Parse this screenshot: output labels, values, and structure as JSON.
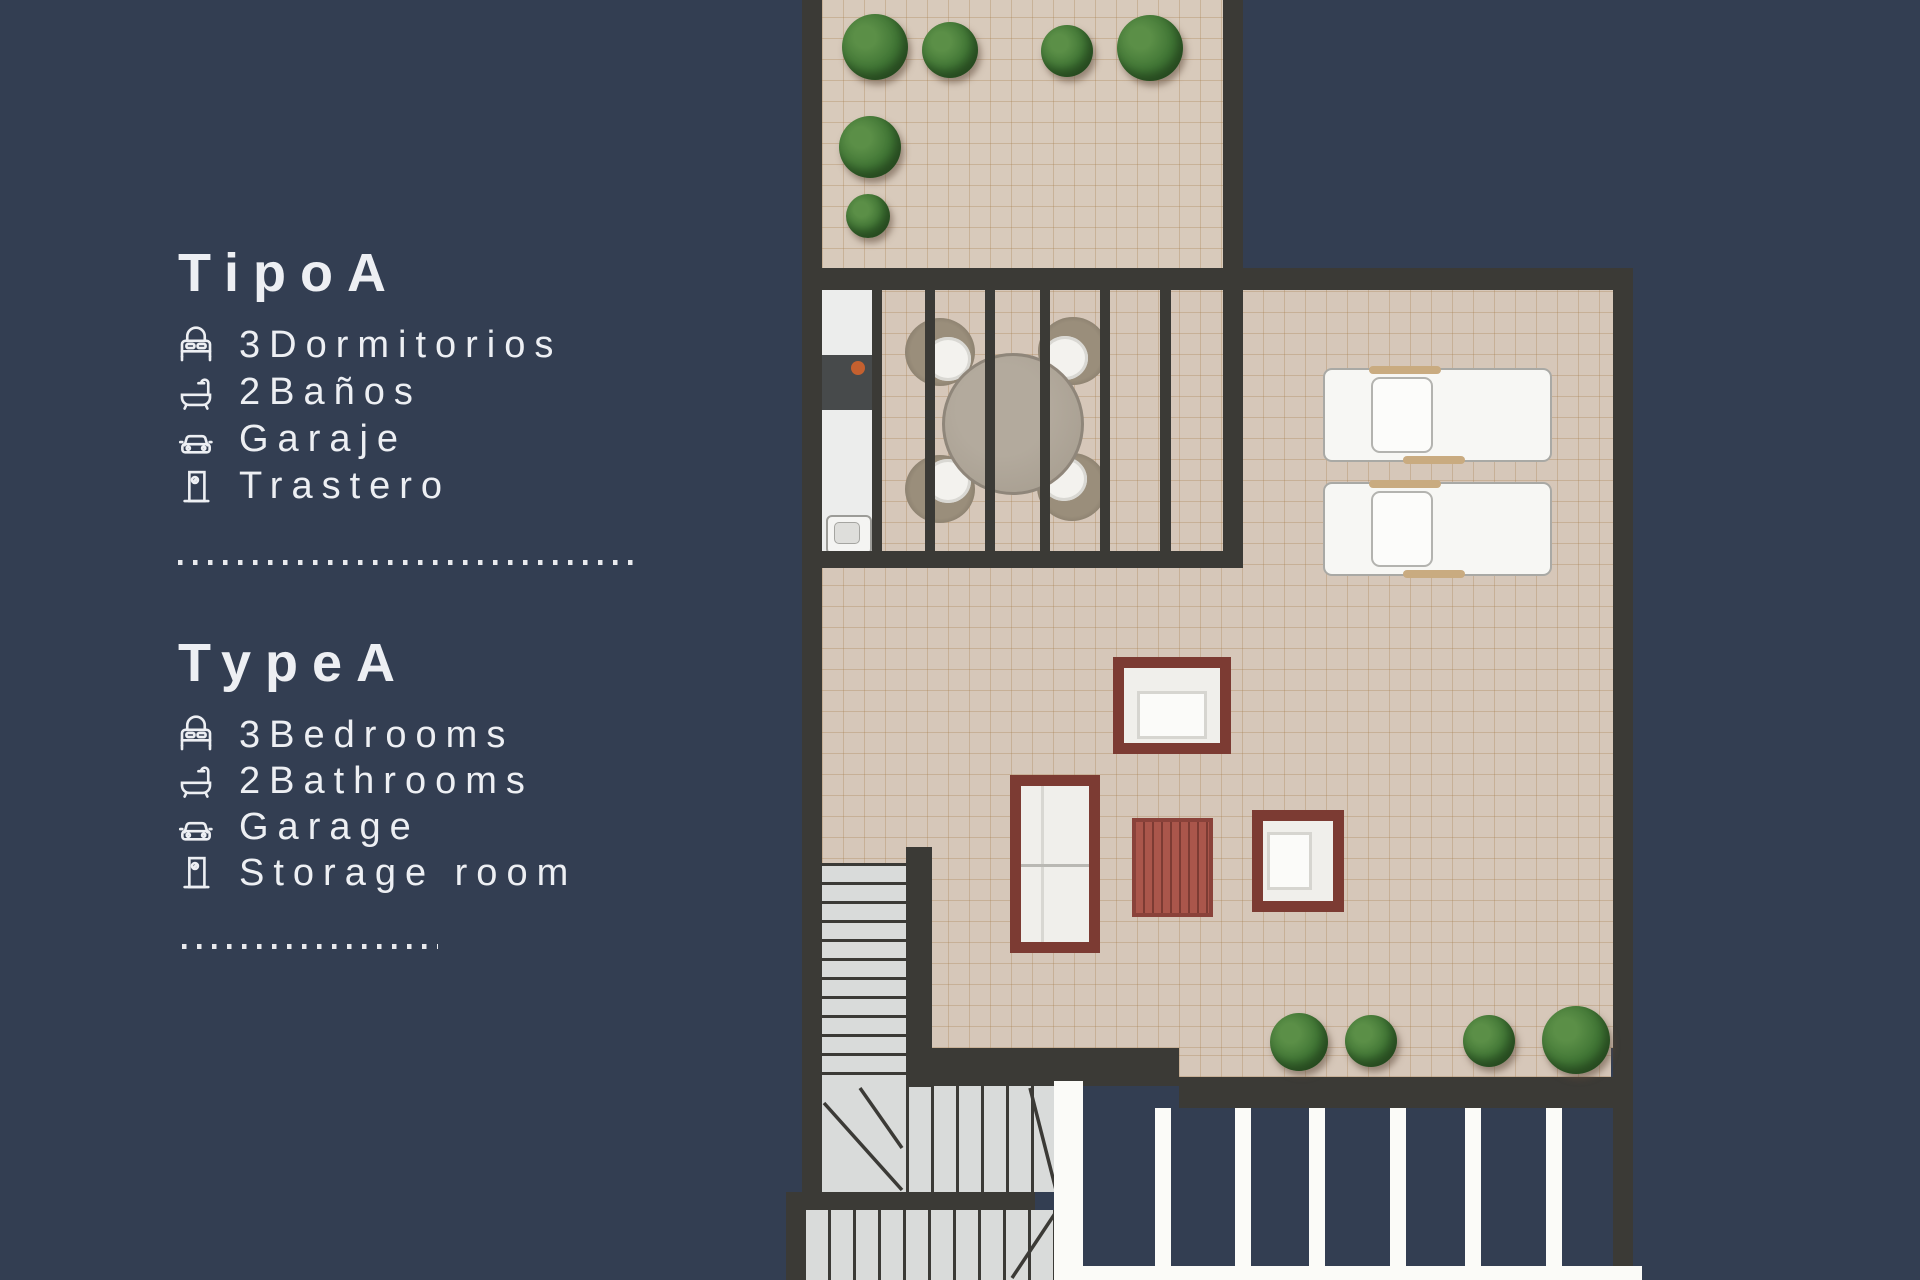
{
  "window": {
    "width": 1920,
    "height": 1280,
    "background_color": "#333e52"
  },
  "info_panel": {
    "text_color": "#edeff3",
    "spanish": {
      "title": "TipoA",
      "items": [
        {
          "icon": "bed-icon",
          "label": "3Dormitorios"
        },
        {
          "icon": "bathtub-icon",
          "label": "2Baños"
        },
        {
          "icon": "car-icon",
          "label": "Garaje"
        },
        {
          "icon": "door-icon",
          "label": "Trastero"
        }
      ]
    },
    "english": {
      "title": "TypeA",
      "items": [
        {
          "icon": "bed-icon",
          "label": "3Bedrooms"
        },
        {
          "icon": "bathtub-icon",
          "label": "2Bathrooms"
        },
        {
          "icon": "car-icon",
          "label": "Garage"
        },
        {
          "icon": "door-icon",
          "label": "Storage room"
        }
      ]
    },
    "dividers": {
      "style": "dotted",
      "color": "#e9eaee"
    }
  },
  "floorplan": {
    "colors": {
      "wall": "#3b3a36",
      "floor_tile": "#d6c7b9",
      "tile_grid": "#b99d72",
      "furniture_frame_red": "#7c3b33",
      "coffee_table_red": "#aa564b",
      "bush_green": "#40743a",
      "stair_tread": "#d9dbda",
      "railing_white": "#fbfbf8",
      "counter_white": "#ecedec",
      "burner_orange": "#c4602f"
    },
    "visible_objects": [
      "roof-terrace-with-6-bushes",
      "pergola-slatted-roof",
      "kitchen-counter-cooktop-sink",
      "round-dining-table-4-wicker-chairs",
      "2-sun-loungers",
      "armchair",
      "sofa",
      "slatted-coffee-table",
      "second-armchair",
      "l-shaped-staircase",
      "4-bushes-on-lower-edge",
      "white-railing-posts"
    ]
  }
}
